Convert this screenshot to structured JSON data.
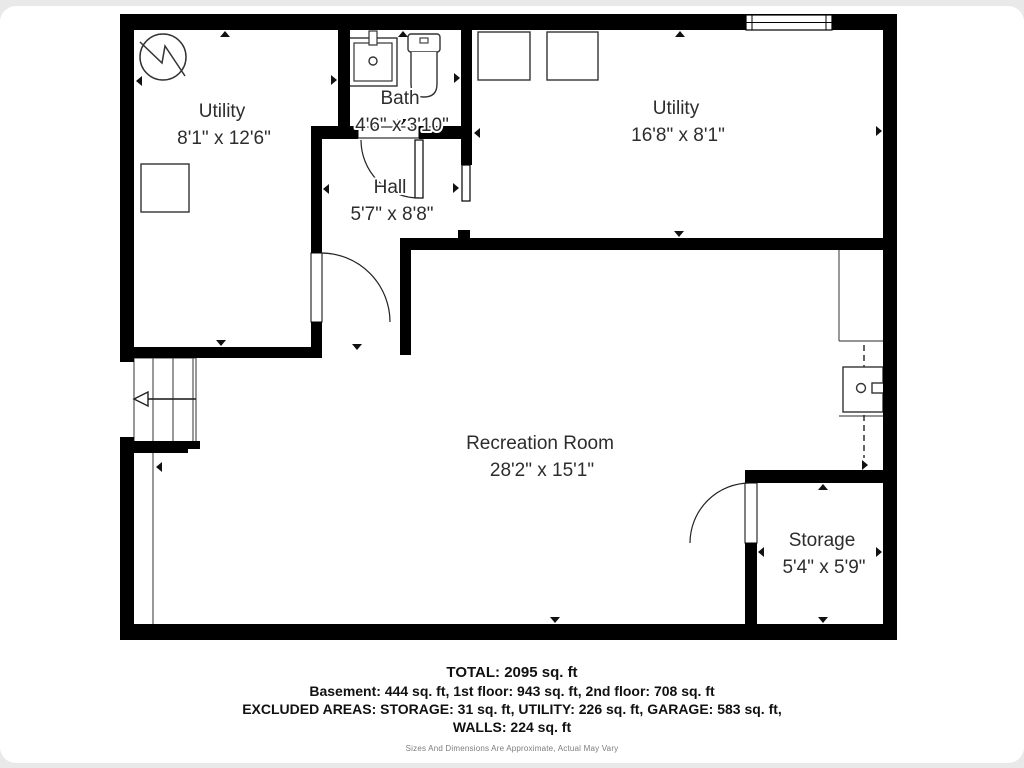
{
  "page": {
    "background": "#e9e9e9",
    "card_background": "#ffffff",
    "wall_color": "#000000",
    "thin_line_color": "#555555",
    "fixture_line_color": "#333333",
    "label_color": "#2d2d2d"
  },
  "rooms": [
    {
      "name": "Utility",
      "dims": "8'1\" x 12'6\"",
      "x": 222,
      "y": 112
    },
    {
      "name": "Bath",
      "dims": "4'6\" x 3'10\"",
      "x": 400,
      "y": 99
    },
    {
      "name": "Hall",
      "dims": "5'7\" x 8'8\"",
      "x": 390,
      "y": 188
    },
    {
      "name": "Utility",
      "dims": "16'8\" x 8'1\"",
      "x": 676,
      "y": 109
    },
    {
      "name": "Recreation Room",
      "dims": "28'2\" x 15'1\"",
      "x": 540,
      "y": 444
    },
    {
      "name": "Storage",
      "dims": "5'4\" x 5'9\"",
      "x": 822,
      "y": 541
    }
  ],
  "footer": {
    "total": "TOTAL: 2095 sq. ft",
    "floors": "Basement: 444 sq. ft, 1st floor: 943 sq. ft, 2nd floor: 708 sq. ft",
    "excluded": "EXCLUDED AREAS: STORAGE: 31 sq. ft, UTILITY: 226 sq. ft, GARAGE: 583 sq. ft,",
    "walls": "WALLS: 224 sq. ft",
    "disclaimer": "Sizes And Dimensions Are Approximate, Actual May Vary"
  },
  "plan": {
    "walls": [
      [
        120,
        14,
        777,
        16
      ],
      [
        120,
        14,
        14,
        348
      ],
      [
        120,
        437,
        14,
        203
      ],
      [
        120,
        624,
        777,
        16
      ],
      [
        883,
        14,
        14,
        626
      ],
      [
        338,
        30,
        12,
        107
      ],
      [
        311,
        126,
        47,
        13
      ],
      [
        419,
        126,
        53,
        13
      ],
      [
        311,
        139,
        11,
        114
      ],
      [
        311,
        322,
        11,
        36
      ],
      [
        122,
        347,
        200,
        11
      ],
      [
        461,
        30,
        11,
        135
      ],
      [
        458,
        230,
        12,
        9
      ],
      [
        400,
        238,
        497,
        12
      ],
      [
        400,
        238,
        11,
        117
      ],
      [
        745,
        470,
        152,
        13
      ],
      [
        745,
        543,
        12,
        81
      ],
      [
        122,
        441,
        66,
        12
      ],
      [
        184,
        441,
        16,
        8
      ]
    ],
    "door_openings": [
      [
        358,
        127,
        61,
        11
      ],
      [
        311,
        253,
        11,
        69
      ],
      [
        745,
        483,
        12,
        60
      ]
    ],
    "door_leaves": [
      [
        415,
        140,
        8,
        58
      ],
      [
        462,
        165,
        8,
        36
      ]
    ],
    "door_arcs": [
      "M321,253 A69,69 0 0 1 390,322",
      "M361,140 A58,58 0 0 0 419,198",
      "M750,483 A60,60 0 0 0 690,543"
    ],
    "window": {
      "x": 746,
      "y": 15,
      "w": 86,
      "h": 15
    },
    "stairs": {
      "box": [
        134,
        358,
        62,
        85
      ],
      "treads_x": [
        153,
        173,
        193
      ],
      "divider_y": 399,
      "arrow_from_x": 196,
      "arrow_to_x": 138,
      "arrow_y": 399,
      "long_line": [
        153,
        453,
        153,
        624
      ]
    },
    "counter": {
      "lines": [
        [
          839,
          243,
          839,
          341
        ],
        [
          839,
          341,
          883,
          341
        ],
        [
          839,
          416,
          883,
          416
        ]
      ],
      "dashed": [
        864,
        345,
        864,
        458
      ],
      "sink": [
        843,
        367,
        40,
        45
      ],
      "drain": [
        861,
        388,
        4.5
      ],
      "faucet": [
        872,
        383,
        14,
        10
      ]
    },
    "fixtures": {
      "heater_circle": [
        163,
        57,
        23
      ],
      "heater_zigzag": "M140,42 L162,63 L165,46 L185,76",
      "boxes": [
        [
          141,
          164,
          48,
          48
        ],
        [
          478,
          32,
          52,
          48
        ],
        [
          547,
          32,
          51,
          48
        ]
      ],
      "bath_sink": {
        "outer": [
          349,
          38,
          48,
          48
        ],
        "inner": [
          354,
          43,
          38,
          38
        ],
        "faucet": [
          369,
          31,
          8,
          14
        ],
        "drain": [
          373,
          61,
          4
        ]
      },
      "toilet": {
        "tank": [
          408,
          34,
          32,
          18
        ],
        "button": [
          420,
          38,
          8,
          5
        ],
        "bowl": [
          411,
          52,
          26,
          45
        ]
      }
    },
    "markers": [
      [
        225,
        31,
        "up"
      ],
      [
        136,
        81,
        "left"
      ],
      [
        337,
        80,
        "right"
      ],
      [
        460,
        78,
        "right"
      ],
      [
        403,
        31,
        "up"
      ],
      [
        402,
        125,
        "down"
      ],
      [
        323,
        189,
        "left"
      ],
      [
        459,
        188,
        "right"
      ],
      [
        680,
        31,
        "up"
      ],
      [
        474,
        133,
        "left"
      ],
      [
        882,
        131,
        "right"
      ],
      [
        679,
        237,
        "down"
      ],
      [
        221,
        346,
        "down"
      ],
      [
        357,
        350,
        "down"
      ],
      [
        555,
        623,
        "down"
      ],
      [
        156,
        467,
        "left"
      ],
      [
        868,
        465,
        "right"
      ],
      [
        823,
        484,
        "up"
      ],
      [
        758,
        552,
        "left"
      ],
      [
        882,
        552,
        "right"
      ],
      [
        823,
        623,
        "down"
      ]
    ]
  }
}
